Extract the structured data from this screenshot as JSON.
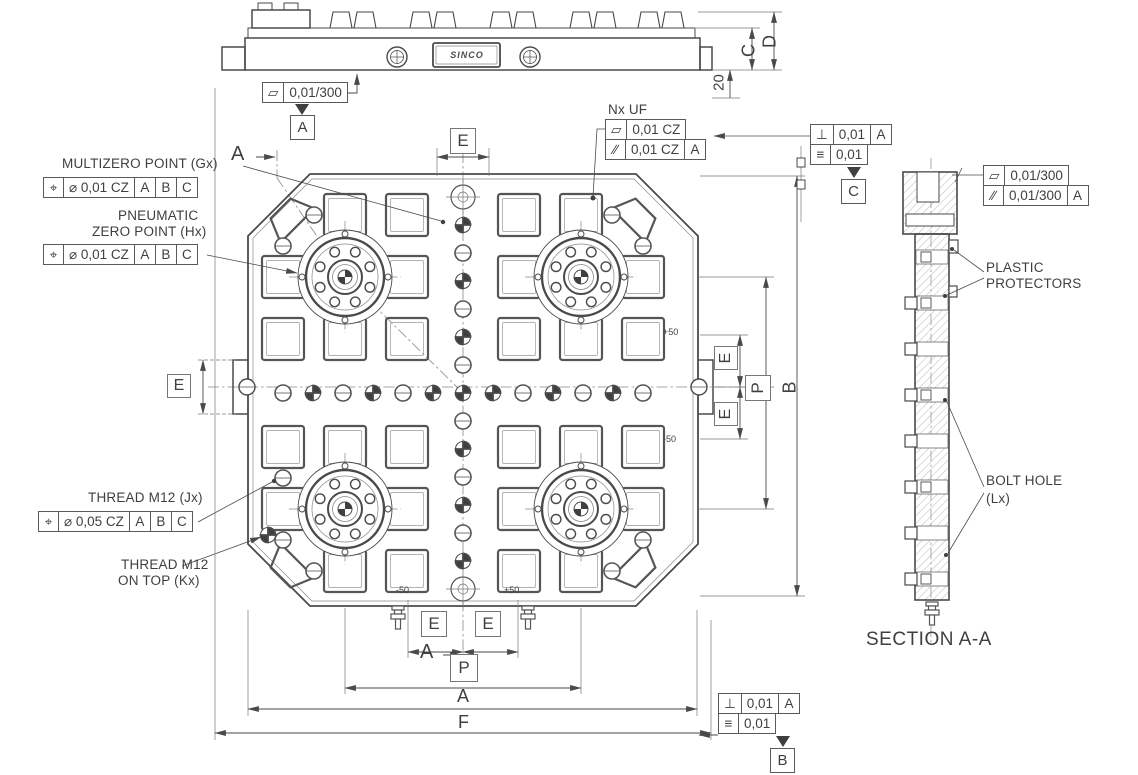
{
  "annotations": {
    "multizero_label": "MULTIZERO POINT (Gx)",
    "pneumatic_label_1": "PNEUMATIC",
    "pneumatic_label_2": "ZERO POINT (Hx)",
    "thread_j_label": "THREAD M12 (Jx)",
    "thread_k_label_1": "THREAD M12",
    "thread_k_label_2": "ON TOP (Kx)",
    "nx_uf_label": "Nx UF",
    "plastic_label_1": "PLASTIC",
    "plastic_label_2": "PROTECTORS",
    "bolt_hole_label_1": "BOLT HOLE",
    "bolt_hole_label_2": "(Lx)",
    "section_label": "SECTION A-A",
    "brand_text": "SINCO"
  },
  "gdt": {
    "multizero": {
      "sym": "⌖",
      "tol": "⌀ 0,01 CZ",
      "d1": "A",
      "d2": "B",
      "d3": "C"
    },
    "pneumatic": {
      "sym": "⌖",
      "tol": "⌀ 0,01 CZ",
      "d1": "A",
      "d2": "B",
      "d3": "C"
    },
    "thread_j": {
      "sym": "⌖",
      "tol": "⌀ 0,05 CZ",
      "d1": "A",
      "d2": "B",
      "d3": "C"
    },
    "top_flat": {
      "sym": "▱",
      "tol": "0,01/300"
    },
    "nxuf_flat": {
      "sym": "▱",
      "tol": "0,01 CZ"
    },
    "nxuf_par": {
      "sym": "∕∕",
      "tol": "0,01 CZ",
      "d1": "A"
    },
    "right_perp": {
      "sym": "⊥",
      "tol": "0,01",
      "d1": "A"
    },
    "right_sym": {
      "sym": "≡",
      "tol": "0,01"
    },
    "sec_flat": {
      "sym": "▱",
      "tol": "0,01/300"
    },
    "sec_par": {
      "sym": "∕∕",
      "tol": "0,01/300",
      "d1": "A"
    },
    "bot_perp": {
      "sym": "⊥",
      "tol": "0,01",
      "d1": "A"
    },
    "bot_sym": {
      "sym": "≡",
      "tol": "0,01"
    }
  },
  "datums": {
    "a": "A",
    "b": "B",
    "c": "C"
  },
  "dims": {
    "e": "E",
    "p": "P",
    "a": "A",
    "b": "B",
    "c": "C",
    "d": "D",
    "f": "F",
    "n20": "20",
    "p50": "+50",
    "m50": "-50"
  },
  "cut": {
    "label": "A"
  },
  "colors": {
    "line": "#4a4a4a",
    "text": "#3f3f3f",
    "hatch": "#9a9a9a"
  }
}
